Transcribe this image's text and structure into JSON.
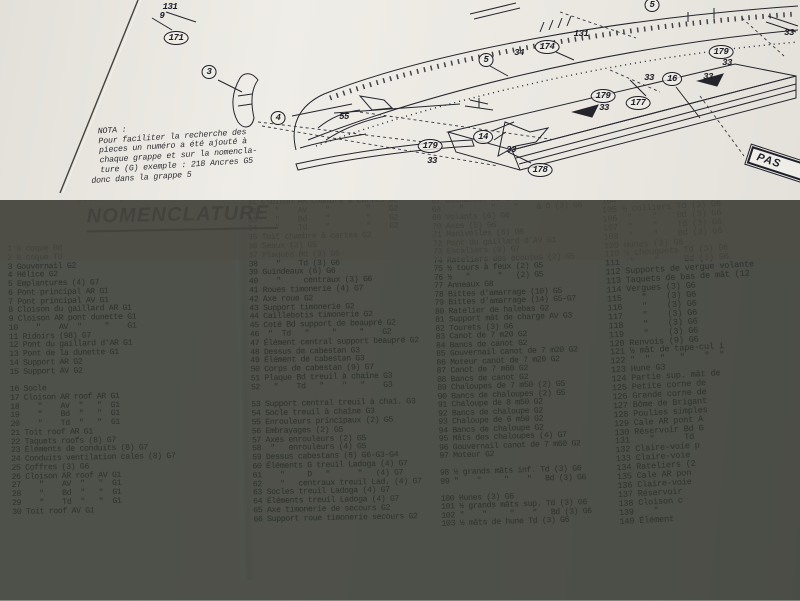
{
  "photo": {
    "mat_color": "#36b2d4",
    "table_color": "#767b72",
    "paper_color": "#e8e6df",
    "ink_color": "#2e2d31"
  },
  "diagram": {
    "nota": [
      "  NOTA :",
      "  Pour faciliter la recherche des",
      "  pieces un numéro a été ajouté à",
      "  chaque grappe et sur la nomencla-",
      "  ture (G) exemple : 218 Ancres G5",
      "donc dans la grappe 5"
    ],
    "plate_label": "PAS",
    "callouts": [
      {
        "label": "131",
        "x": 170,
        "y": 7,
        "circled": false
      },
      {
        "label": "9",
        "x": 162,
        "y": 16,
        "circled": false
      },
      {
        "label": "171",
        "x": 176,
        "y": 38,
        "circled": true
      },
      {
        "label": "3",
        "x": 209,
        "y": 72,
        "circled": true
      },
      {
        "label": "4",
        "x": 278,
        "y": 118,
        "circled": true
      },
      {
        "label": "55",
        "x": 344,
        "y": 117,
        "circled": false
      },
      {
        "label": "179",
        "x": 430,
        "y": 146,
        "circled": true
      },
      {
        "label": "33",
        "x": 432,
        "y": 161,
        "circled": false
      },
      {
        "label": "14",
        "x": 483,
        "y": 137,
        "circled": true
      },
      {
        "label": "33",
        "x": 511,
        "y": 150,
        "circled": false
      },
      {
        "label": "178",
        "x": 540,
        "y": 170,
        "circled": true
      },
      {
        "label": "5",
        "x": 486,
        "y": 60,
        "circled": true
      },
      {
        "label": "34",
        "x": 519,
        "y": 53,
        "circled": false
      },
      {
        "label": "174",
        "x": 547,
        "y": 47,
        "circled": true
      },
      {
        "label": "131",
        "x": 581,
        "y": 34,
        "circled": false
      },
      {
        "label": "5",
        "x": 652,
        "y": 5,
        "circled": true
      },
      {
        "label": "179",
        "x": 603,
        "y": 96,
        "circled": true
      },
      {
        "label": "33",
        "x": 604,
        "y": 108,
        "circled": false
      },
      {
        "label": "177",
        "x": 638,
        "y": 103,
        "circled": true
      },
      {
        "label": "33",
        "x": 649,
        "y": 78,
        "circled": false
      },
      {
        "label": "16",
        "x": 672,
        "y": 79,
        "circled": true
      },
      {
        "label": "33",
        "x": 708,
        "y": 77,
        "circled": false
      },
      {
        "label": "179",
        "x": 721,
        "y": 52,
        "circled": true
      },
      {
        "label": "33",
        "x": 727,
        "y": 63,
        "circled": false
      },
      {
        "label": "33",
        "x": 789,
        "y": 33,
        "circled": false
      }
    ]
  },
  "sheet": {
    "doc_ref": "80888 Page 4",
    "title": "NOMENCLATURE",
    "columns": [
      {
        "lines": [
          "1 ½ coque Bd",
          "2 ½ coque Td",
          "3 Gouvernail G2",
          "4 Hélice G2",
          "5 Emplantures (4) G7",
          "6 Pont principal AR G1",
          "7 Pont principal AV G1",
          "8 Cloison du gaillard AR G1",
          "9 Cloison AR pont dunette G1",
          "10    \"    AV  \"     \"    G1",
          "11 Ridoirs (98) G7",
          "12 Pont du gaillard d'AR G1",
          "13 Pont de la dunette G1",
          "14 Support AR G2",
          "15 Support AV G2",
          "",
          "16 Socle",
          "17 Cloison AR roof AR G1",
          "18    \"    AV  \"   \"  G1",
          "19    \"    Bd  \"   \"  G1",
          "20    \"    Td  \"   \"  G1",
          "21 Toit roof AR G1",
          "22 Taquets roofs (8) G7",
          "23 Éléments de conduits (8) G7",
          "24 Conduits ventilation cales (8) G7",
          "25 Coffres (3) G6",
          "26 Cloison AR roof AV G1",
          "27    \"    AV  \"   \"  G1",
          "28    \"    Bd  \"   \"  G1",
          "29    \"    Td  \"   \"  G1",
          "30 Toit roof AV G1"
        ]
      },
      {
        "lines": [
          "31 Cloison AR chambre à cartes G2",
          "32    \"    AV    \"        \"    G2",
          "33    \"    Bd    \"        \"    G2",
          "34    \"    Td    \"        \"    G2",
          "35 Toit chambre à cartes G2",
          "36 Seaux (2) G5",
          "37 Plaques Bd (3) G6",
          "38    \"    Td (3) G6",
          "39 Guindeaux (6) G6",
          "40    \"     centraux (3) G6",
          "41 Roues timonerie (4) G7",
          "42 Axe roue G2",
          "43 Support timonerie G2",
          "44 Caillebotis timonerie G2",
          "45 Coté Bd support de beaupré G2",
          "46  \"  Td   \"     \"     \"    G2",
          "47 Élément central support beaupré G2",
          "48 Dessus de cabestan G3",
          "49 Élément de cabestan G3",
          "50 Corps de cabestan (9) G7",
          "51 Plaque Bd treuil à chaîne G3",
          "52   \"    Td   \"    \"   \"    G3",
          "",
          "53 Support central treuil à chaî. G3",
          "54 Socle treuil à chaîne G3",
          "55 Enrouleurs principaux (2) G5",
          "56 Embrayages (2) G5",
          "57 Axes enrouleurs (2) G5",
          "58  \"   enrouleurs (4) G5",
          "59 Dessus cabestans (8) G6-G3-G4",
          "60 Éléments G treuil Ladoga (4) G7",
          "61    \"     D   \"      \"   (4) G7",
          "62    \"   centraux treuil Lad. (4) G7",
          "63 Socles treuil Ladoga (4) G7",
          "64 Éléments treuil Ladoga (4) G7",
          "65 Axe timonerie de secours G2",
          "66 Support roue timonerie secours G2"
        ]
      },
      {
        "lines": [
          "67 Guindeaux de drisse à G (3) G6",
          "68    \"      \"    \"    à D (3) G6",
          "69 Volants (6) G6",
          "70 Axes (5) G6",
          "71 Manivelles (6) G6",
          "72 Pont du gaillard d'AV G1",
          "73 Escaliers (8) G7",
          "74 Rateliers des écoutes (2) G5",
          "75 ½ tours à feux (2) G5",
          "76 ½   \"      \"   (2) G5",
          "77 Anneaux G8",
          "78 Bittes d'amarrage (10) G5",
          "79 Bittes d'amarrage (14) G5-G7",
          "80 Ratelier de halebas G2",
          "81 Support mât de charge AV G3",
          "82 Tourets (3) G6",
          "83 Canot de 7 m20 G2",
          "84 Bancs de canot G2",
          "85 Gouvernail canot de 7 m20 G2",
          "86 Moteur canot de 7 m20 G2",
          "87 Canot de 7 m60 G2",
          "88 Bancs de canot G2",
          "89 Chaloupes de 7 m50 (2) G5",
          "90 Bancs de chaloupes (2) G5",
          "91 Chaloupe de 8 m50 G2",
          "92 Bancs de chaloupe G2",
          "93 Chaloupe de 6 m50 G2",
          "94 Bancs de chaloupe G2",
          "95 Mâts des chaloupes (4) G7",
          "96 Gouvernail canot de 7 m60 G2",
          "97 Moteur G2",
          "",
          "98 ½ grands mâts inf. Td (3) G6",
          "99 \"    \"     \"    \"   Bd (3) G6",
          "",
          "100 Hunes (3) G6",
          "101 ½ grands mâts sup. Td (3) G6",
          "102 \"    \"     \"    \"   Bd (3) G6",
          "103 ½ mâts de hune Td (3) G6"
        ]
      },
      {
        "lines": [
          "104 \"    \"       Bd (3) G6",
          "105 ½ colliers Td (3) G6",
          "106  \"    \"    Bd (3) G6",
          "107  \"    \"    Td (3) G6",
          "108  \"    \"    Bd (3) G6",
          "109 Hunes (3) G6",
          "110 ½ chouquets Td (3) G6",
          "111  \"    \"     Bd (3) G6",
          "112 Supports de vergue volante",
          "113 Taquets de bas de mât (12",
          "114 Vergues (3) G6",
          "115    \"    (3) G6",
          "116    \"    (3) G6",
          "117    \"    (3) G6",
          "118    \"    (3) G6",
          "119    \"    (3) G6",
          "120 Renvois (9) G6",
          "121 ½ mât de tape-cul i",
          "122 \"  \"  \"   \"    \"  \"",
          "123 Hune G3",
          "124 Partie sup. mât de",
          "125 Petite corne de",
          "126 Grande corne de",
          "127 Bôme de Brigant",
          "128 Poulies simples",
          "129 Cale AR pont A",
          "130 Réservoir Bd G",
          "131    \"      Td",
          "132 Claire-voie p",
          "133 Claire-voie",
          "134 Rateliers (2",
          "135 Cale AR pon",
          "136 Claire-voie",
          "137 Réservoir",
          "138 Cloison c",
          "139    \"",
          "140 Élément"
        ]
      }
    ]
  }
}
